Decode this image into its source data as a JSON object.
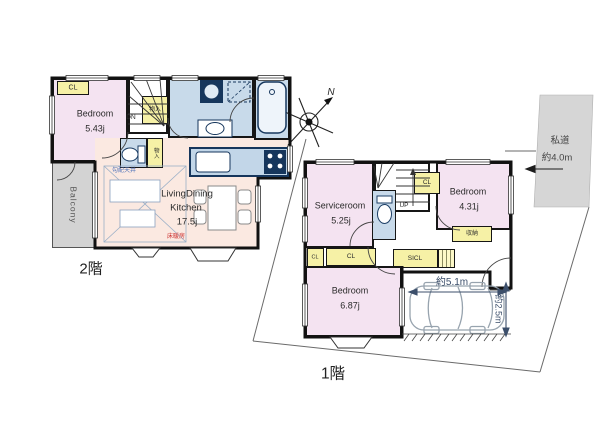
{
  "floor2": {
    "floor_label": "2階",
    "bedroom_name": "Bedroom",
    "bedroom_area": "5.43j",
    "ldk_name1": "LivingDining",
    "ldk_name2": "Kitchen",
    "ldk_area": "17.5j",
    "balcony_label": "Balcony",
    "closet_label": "CL",
    "stairs_storage_label": "物入",
    "toilet_storage_label": "物入",
    "stairs_label": "DN",
    "sloped_ceiling_label": "勾配天井",
    "floor_heating_label": "床暖房"
  },
  "floor1": {
    "floor_label": "1階",
    "serviceroom_name": "Serviceroom",
    "serviceroom_area": "5.25j",
    "bedroom_east_name": "Bedroom",
    "bedroom_east_area": "4.31j",
    "bedroom_south_name": "Bedroom",
    "bedroom_south_area": "6.87j",
    "closet_east_label": "CL",
    "closet_a_label": "CL",
    "closet_b_label": "CL",
    "shoe_closet_label": "SICL",
    "storage_label": "収納",
    "stairs_label": "UP",
    "parking_width_label": "約5.1m",
    "parking_depth_label": "約2.5m"
  },
  "site": {
    "compass_label": "N",
    "road_name_label": "私道",
    "road_width_label": "約4.0m"
  }
}
